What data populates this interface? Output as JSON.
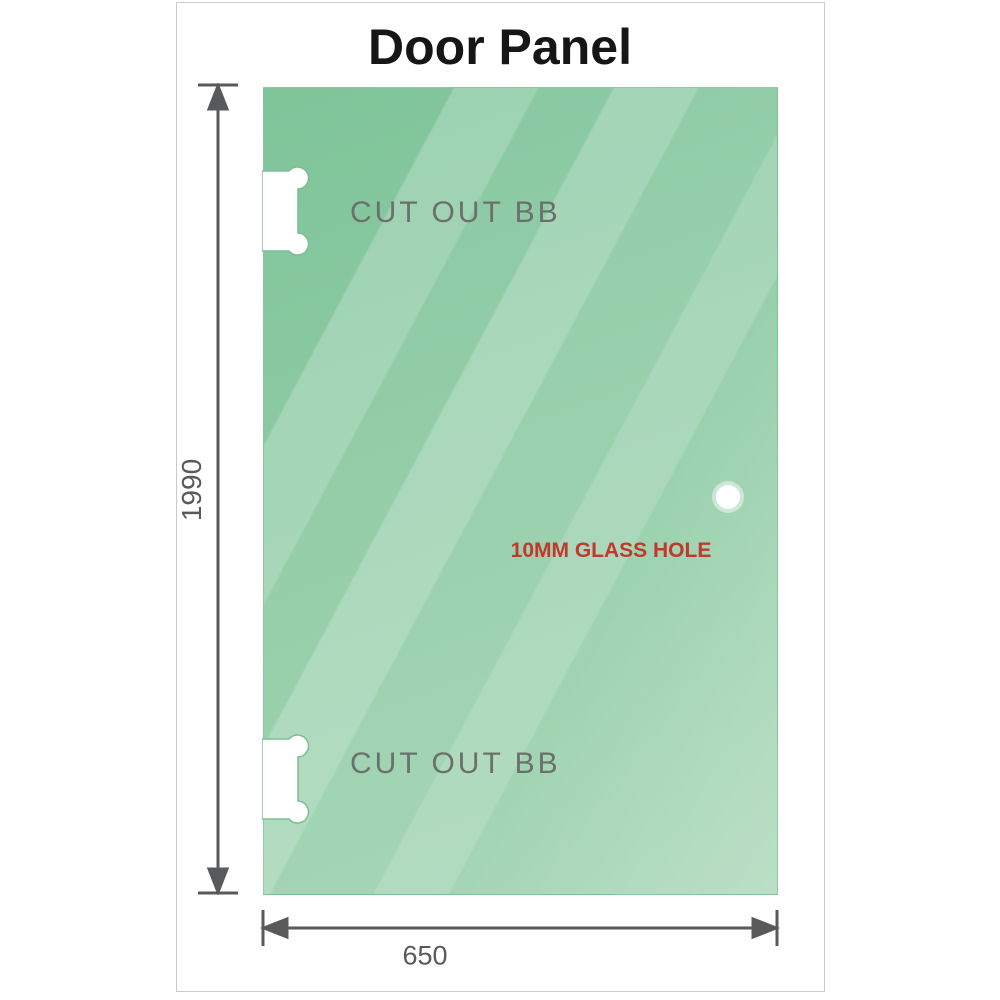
{
  "title": "Door Panel",
  "panel": {
    "glass_top_color": "#84c79d",
    "glass_bottom_color": "#9ed3af",
    "stripe_highlight_color": "#bfe2ca",
    "cutouts": [
      {
        "label": "CUT OUT BB"
      },
      {
        "label": "CUT OUT BB"
      }
    ],
    "glass_hole": {
      "label": "10MM GLASS HOLE",
      "label_color": "#c0392b"
    }
  },
  "dimensions": {
    "height": {
      "value": "1990"
    },
    "width": {
      "value": "650"
    },
    "line_color": "#58595b",
    "text_color": "#58595b"
  }
}
